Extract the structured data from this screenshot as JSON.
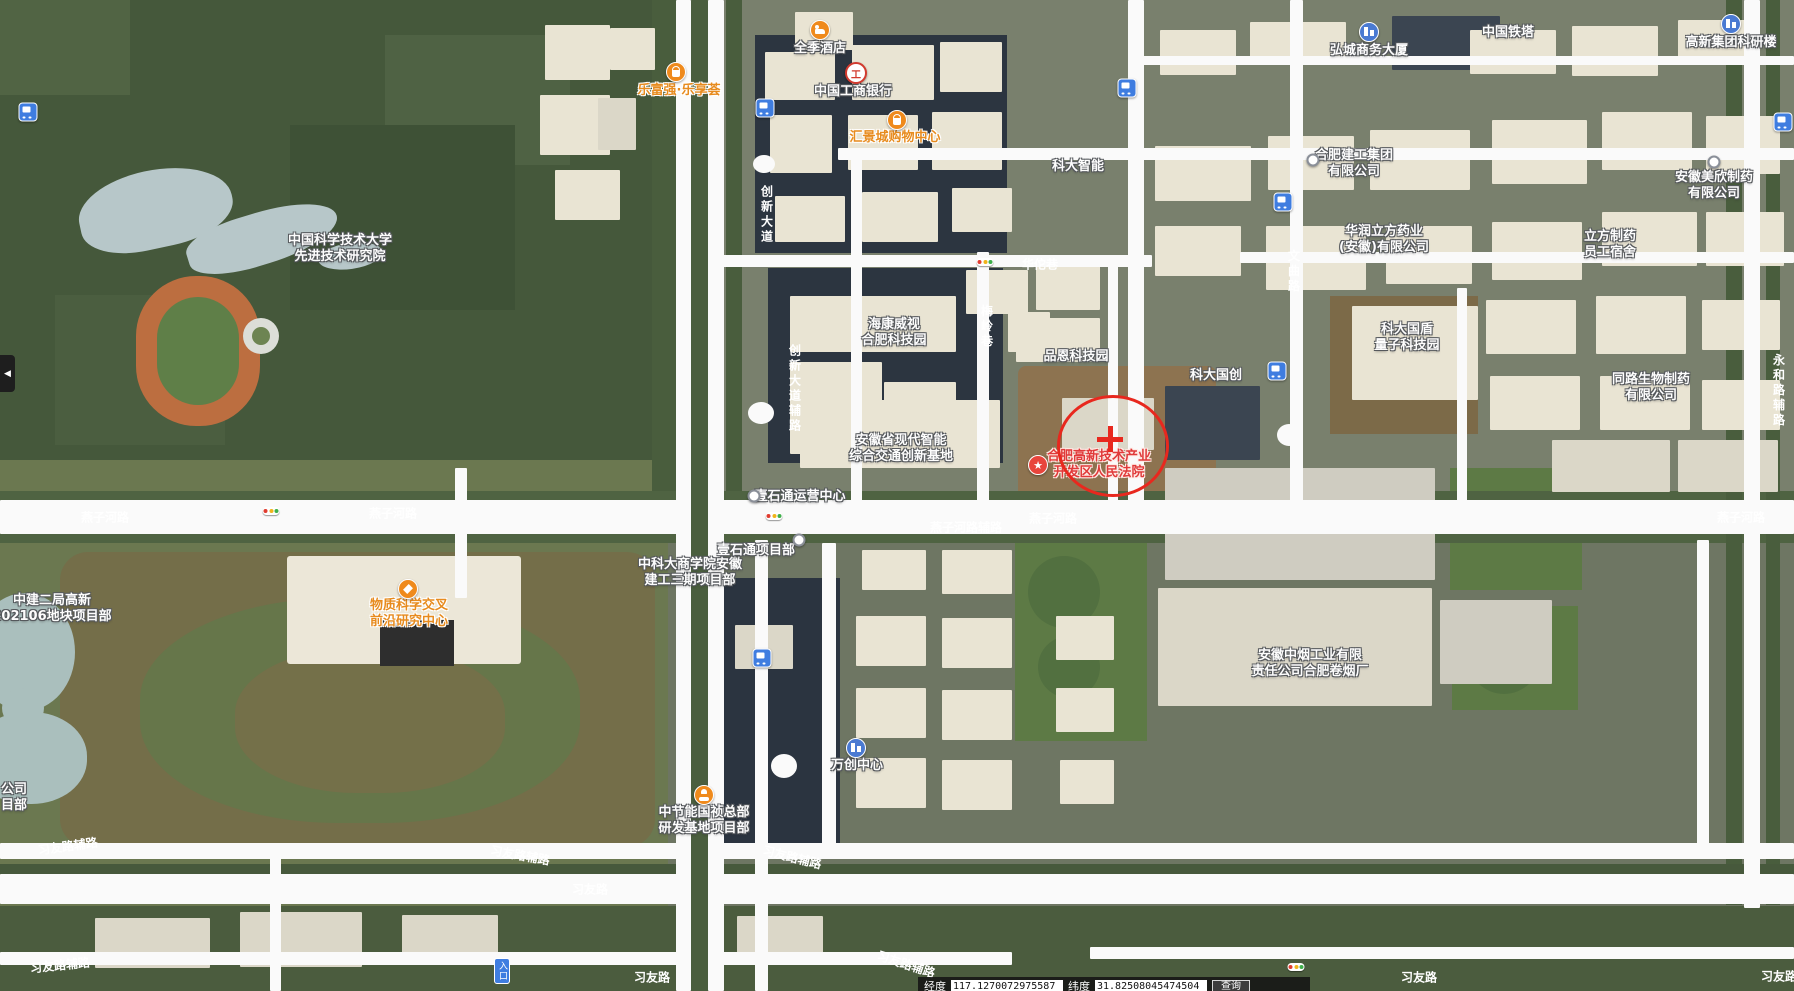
{
  "colors": {
    "marker_red": "#e8281e",
    "poi_orange": "#e78b1e",
    "poi_red_text": "#e03a3a",
    "transit_blue": "#3f7de0",
    "road_white": "#fafafa"
  },
  "map": {
    "pois": [
      {
        "name": "poi-ustc-advanced-institute",
        "lines": [
          "中国科学技术大学",
          "先进技术研究院"
        ],
        "x": 340,
        "y": 249,
        "style": "white"
      },
      {
        "name": "poi-quanji-hotel",
        "lines": [
          "全季酒店"
        ],
        "x": 820,
        "y": 49,
        "style": "white",
        "icon": {
          "type": "hotel",
          "x": 820,
          "y": 30
        }
      },
      {
        "name": "poi-lefuqiang-lexianghui",
        "lines": [
          "乐富强·乐享荟"
        ],
        "x": 679,
        "y": 91,
        "style": "orange",
        "icon": {
          "type": "shopping",
          "x": 676,
          "y": 72
        }
      },
      {
        "name": "poi-icbc-bank",
        "lines": [
          "中国工商银行"
        ],
        "x": 853,
        "y": 92,
        "style": "white",
        "icon": {
          "type": "icbc",
          "x": 856,
          "y": 73,
          "glyph": "工"
        }
      },
      {
        "name": "poi-huijingcheng-mall",
        "lines": [
          "汇景城购物中心"
        ],
        "x": 895,
        "y": 138,
        "style": "orange",
        "icon": {
          "type": "shopping",
          "x": 897,
          "y": 120
        }
      },
      {
        "name": "poi-keda-zhineng",
        "lines": [
          "科大智能"
        ],
        "x": 1078,
        "y": 167,
        "style": "white"
      },
      {
        "name": "poi-china-tower",
        "lines": [
          "中国铁塔"
        ],
        "x": 1508,
        "y": 33,
        "style": "white"
      },
      {
        "name": "poi-hongcheng-business-tower",
        "lines": [
          "弘城商务大厦"
        ],
        "x": 1369,
        "y": 51,
        "style": "white",
        "icon": {
          "type": "building",
          "x": 1369,
          "y": 32
        }
      },
      {
        "name": "poi-gaoxin-group-research-building",
        "lines": [
          "高新集团科研楼"
        ],
        "x": 1731,
        "y": 43,
        "style": "white",
        "icon": {
          "type": "building",
          "x": 1731,
          "y": 24
        }
      },
      {
        "name": "poi-hefei-construction-group",
        "lines": [
          "合肥建工集团",
          "有限公司"
        ],
        "x": 1354,
        "y": 164,
        "style": "white",
        "icon": {
          "type": "dot",
          "x": 1313,
          "y": 160
        }
      },
      {
        "name": "poi-huarun-lifang-pharma",
        "lines": [
          "华润立方药业",
          "(安徽)有限公司"
        ],
        "x": 1384,
        "y": 240,
        "style": "white"
      },
      {
        "name": "poi-lifang-pharma-dormitory",
        "lines": [
          "立方制药",
          "员工宿舍"
        ],
        "x": 1610,
        "y": 245,
        "style": "white"
      },
      {
        "name": "poi-anhui-meixin-pharma",
        "lines": [
          "安徽美欣制药",
          "有限公司"
        ],
        "x": 1714,
        "y": 186,
        "style": "white",
        "icon": {
          "type": "dot",
          "x": 1714,
          "y": 162
        }
      },
      {
        "name": "poi-hikvision-hefei-tech-park",
        "lines": [
          "海康威视",
          "合肥科技园"
        ],
        "x": 894,
        "y": 333,
        "style": "white"
      },
      {
        "name": "poi-pinen-tech-park",
        "lines": [
          "品恩科技园"
        ],
        "x": 1076,
        "y": 357,
        "style": "white"
      },
      {
        "name": "poi-keda-guochuang",
        "lines": [
          "科大国创"
        ],
        "x": 1216,
        "y": 376,
        "style": "white"
      },
      {
        "name": "poi-guodun-quantum-tech-park",
        "lines": [
          "科大国盾",
          "量子科技园"
        ],
        "x": 1407,
        "y": 338,
        "style": "white"
      },
      {
        "name": "poi-tonglu-biopharma",
        "lines": [
          "同路生物制药",
          "有限公司"
        ],
        "x": 1651,
        "y": 388,
        "style": "white"
      },
      {
        "name": "poi-anhui-intelligent-transport-base",
        "lines": [
          "安徽省现代智能",
          "综合交通创新基地"
        ],
        "x": 901,
        "y": 449,
        "style": "white"
      },
      {
        "name": "poi-hefei-hightech-court",
        "lines": [
          "合肥高新技术产业",
          "开发区人民法院"
        ],
        "x": 1099,
        "y": 465,
        "style": "red",
        "icon": {
          "type": "star",
          "x": 1038,
          "y": 465,
          "glyph": "★"
        }
      },
      {
        "name": "poi-matter-science-research-center",
        "lines": [
          "物质科学交叉",
          "前沿研究中心"
        ],
        "x": 409,
        "y": 614,
        "style": "orange",
        "icon": {
          "type": "landmark",
          "x": 408,
          "y": 589
        }
      },
      {
        "name": "poi-ustc-business-school-project",
        "lines": [
          "中科大商学院安徽",
          "建工三期项目部"
        ],
        "x": 690,
        "y": 573,
        "style": "white"
      },
      {
        "name": "poi-yishitong-project-dept",
        "lines": [
          "壹石通项目部"
        ],
        "x": 756,
        "y": 551,
        "style": "white",
        "icon": {
          "type": "dot",
          "x": 799,
          "y": 540
        }
      },
      {
        "name": "poi-yishitong-operation-center",
        "lines": [
          "壹石通运营中心"
        ],
        "x": 800,
        "y": 497,
        "style": "white",
        "icon": {
          "type": "dot",
          "x": 754,
          "y": 496
        }
      },
      {
        "name": "poi-wanchuang-center",
        "lines": [
          "万创中心"
        ],
        "x": 857,
        "y": 766,
        "style": "white",
        "icon": {
          "type": "building",
          "x": 856,
          "y": 748
        }
      },
      {
        "name": "poi-anhui-tobacco-hefei-factory",
        "lines": [
          "安徽中烟工业有限",
          "责任公司合肥卷烟厂"
        ],
        "x": 1310,
        "y": 664,
        "style": "white"
      },
      {
        "name": "poi-cecep-guozhen-rd-base-project",
        "lines": [
          "中节能国祯总部",
          "研发基地项目部"
        ],
        "x": 704,
        "y": 821,
        "style": "white",
        "icon": {
          "type": "construction",
          "x": 704,
          "y": 795
        }
      },
      {
        "name": "poi-zhongjian-plot-project",
        "lines": [
          "中建二局高新",
          "202106地块项目部"
        ],
        "x": 52,
        "y": 609,
        "style": "white"
      },
      {
        "name": "poi-clipped-label-fragment",
        "lines": [
          "公司",
          "目部"
        ],
        "x": 14,
        "y": 798,
        "style": "white"
      }
    ],
    "road_labels": [
      {
        "name": "road-yanzihe-1",
        "text": "燕子河路",
        "x": 105,
        "y": 518
      },
      {
        "name": "road-yanzihe-2",
        "text": "燕子河路",
        "x": 393,
        "y": 514
      },
      {
        "name": "road-yanzihe-3",
        "text": "燕子河路",
        "x": 1053,
        "y": 519
      },
      {
        "name": "road-yanzihe-4",
        "text": "燕子河路",
        "x": 1741,
        "y": 518
      },
      {
        "name": "road-yanzihe-service",
        "text": "燕子河路辅路",
        "x": 966,
        "y": 528
      },
      {
        "name": "road-huatuo-lane",
        "text": "华佗巷",
        "x": 1040,
        "y": 265
      },
      {
        "name": "road-meiling-lane",
        "text": "梅岭巷",
        "x": 986,
        "y": 327,
        "vertical": true
      },
      {
        "name": "road-chuangxin-avenue",
        "text": "创新大道",
        "x": 766,
        "y": 215,
        "vertical": true
      },
      {
        "name": "road-chuangxin-avenue-service",
        "text": "创新大道辅路",
        "x": 794,
        "y": 389,
        "vertical": true
      },
      {
        "name": "road-wenqu-road",
        "text": "文曲路",
        "x": 1293,
        "y": 272,
        "vertical": true
      },
      {
        "name": "road-yonghe-service",
        "text": "永和路辅路",
        "x": 1778,
        "y": 391,
        "vertical": true
      },
      {
        "name": "road-xiyou-service-1",
        "text": "习友路辅路",
        "x": 68,
        "y": 847,
        "angle": -8
      },
      {
        "name": "road-xiyou-service-2",
        "text": "习友路辅路",
        "x": 520,
        "y": 856,
        "angle": 10
      },
      {
        "name": "road-xiyou-1",
        "text": "习友路",
        "x": 590,
        "y": 890
      },
      {
        "name": "road-xiyou-service-3",
        "text": "习友路辅路",
        "x": 792,
        "y": 858,
        "angle": 14
      },
      {
        "name": "road-xiyou-service-4",
        "text": "习友路辅路",
        "x": 60,
        "y": 966,
        "angle": -6
      },
      {
        "name": "road-xiyou-2",
        "text": "习友路",
        "x": 652,
        "y": 978
      },
      {
        "name": "road-xiyou-service-5",
        "text": "习友路辅路",
        "x": 906,
        "y": 965,
        "angle": 18
      },
      {
        "name": "road-xiyou-3",
        "text": "习友路",
        "x": 1419,
        "y": 978
      },
      {
        "name": "road-xiyou-4",
        "text": "习友路",
        "x": 1779,
        "y": 977
      }
    ],
    "transit_stops": [
      {
        "name": "bus-stop-1",
        "x": 28,
        "y": 112
      },
      {
        "name": "bus-stop-2",
        "x": 765,
        "y": 108
      },
      {
        "name": "bus-stop-3",
        "x": 1127,
        "y": 88
      },
      {
        "name": "bus-stop-4",
        "x": 1783,
        "y": 122
      },
      {
        "name": "bus-stop-5",
        "x": 1283,
        "y": 202
      },
      {
        "name": "bus-stop-6",
        "x": 1277,
        "y": 371
      },
      {
        "name": "bus-stop-7",
        "x": 762,
        "y": 658
      }
    ],
    "traffic_lights": [
      {
        "x": 985,
        "y": 262
      },
      {
        "x": 271,
        "y": 511
      },
      {
        "x": 774,
        "y": 516
      },
      {
        "x": 1296,
        "y": 967
      }
    ],
    "marker": {
      "x": 1057,
      "y": 395,
      "w": 106,
      "h": 96,
      "cross_x": 1110,
      "cross_y": 439
    },
    "entrance_badge": {
      "label": "入口",
      "x": 494,
      "y": 958
    }
  },
  "controls": {
    "collapse_glyph": "◀"
  },
  "coordinate_bar": {
    "lng_label": "经度",
    "lng_value": "117.1270072975587",
    "lat_label": "纬度",
    "lat_value": "31.82508045474504",
    "search_label": "查询"
  }
}
